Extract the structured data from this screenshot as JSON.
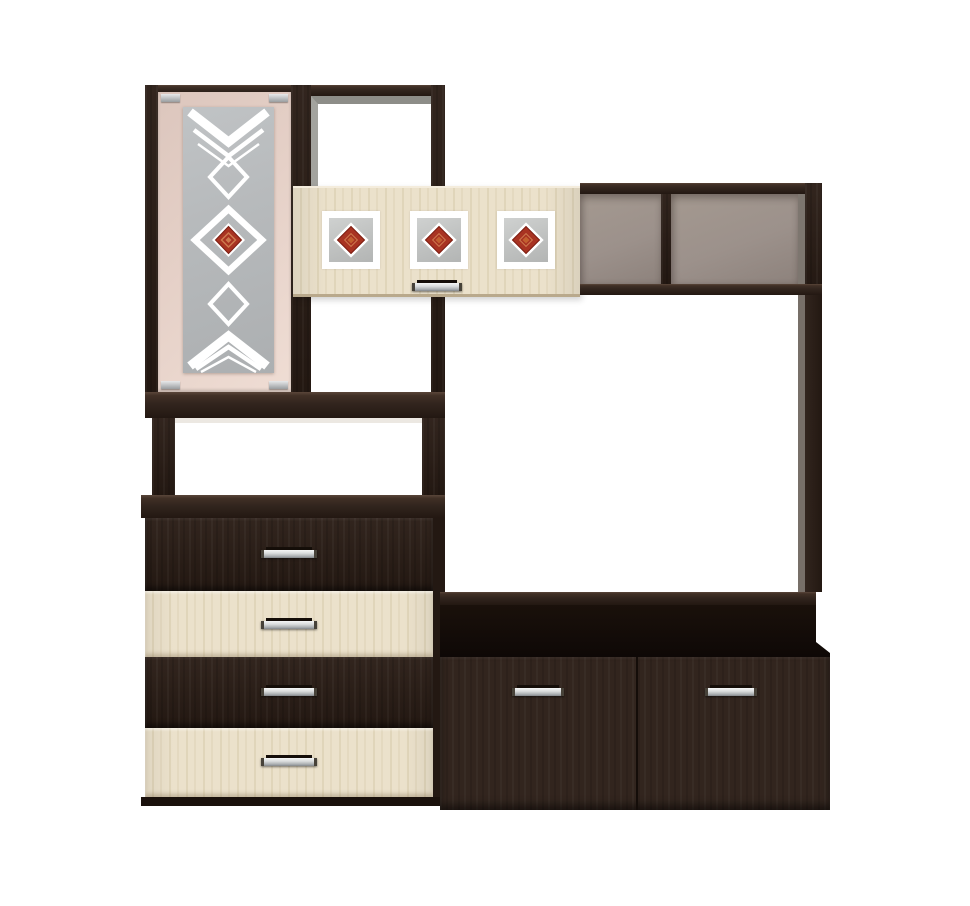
{
  "image": {
    "kind": "product-photo",
    "subject": "living-room wall unit with glass-door cabinet, four-drawer dresser, open shelves and TV stand",
    "background": "#ffffff"
  },
  "colors": {
    "wenge": "#32251e",
    "wenge_deep": "#231812",
    "oak": "#ebe1cb",
    "door": "#e5d0c7",
    "glass": "#b7babc",
    "back_panel": "#9c918b",
    "accent_red": "#a83322",
    "silver": "#d6d9da"
  },
  "parts": {
    "glass_door": {
      "decorations": [
        "triple-chevron-down",
        "small-diamond",
        "large-red-diamond",
        "small-diamond",
        "triple-chevron-up"
      ],
      "hinge_count": 4
    },
    "wall_cabinet": {
      "panel_count": 3,
      "panel_motif": "red-diamond-on-gray",
      "handle_count": 1
    },
    "open_shelf": {
      "compartment_count": 2
    },
    "dresser": {
      "drawer_count": 4,
      "drawer_finishes": [
        "wenge",
        "oak",
        "wenge",
        "oak"
      ],
      "handle_count": 4
    },
    "tv_stand": {
      "drawer_count": 2,
      "drawer_finishes": [
        "wenge",
        "wenge"
      ],
      "handle_count": 2
    }
  }
}
